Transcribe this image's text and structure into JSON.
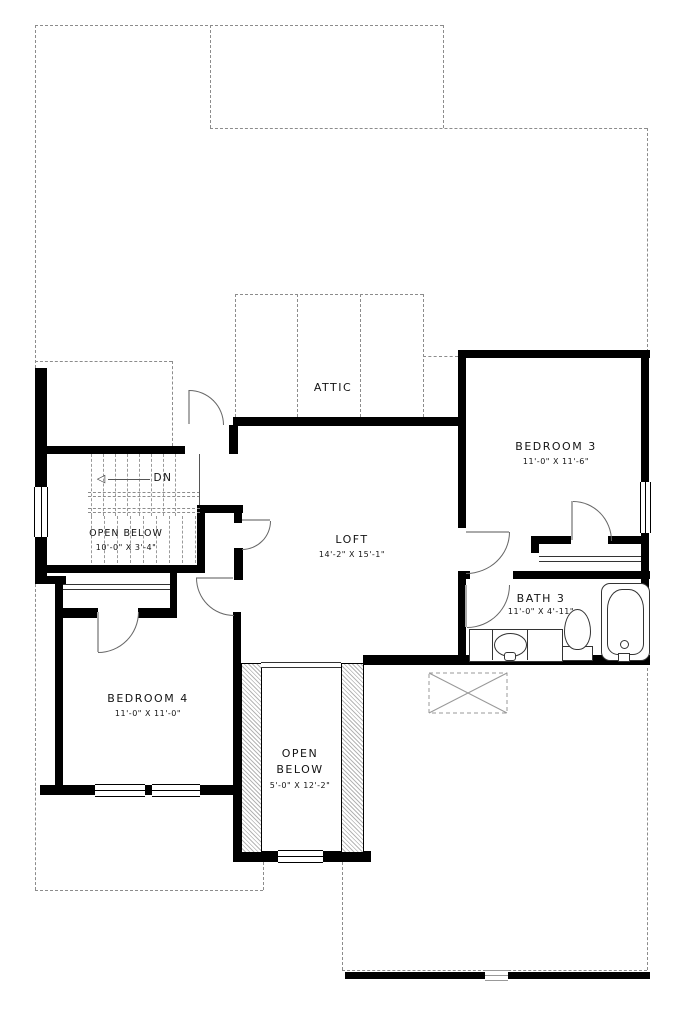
{
  "plan": {
    "title": "second-floor-plan",
    "labels": {
      "attic": "ATTIC",
      "dn": "DN",
      "down_arrow": "◁"
    },
    "rooms": {
      "loft": {
        "name": "LOFT",
        "dims": "14'-2\" X 15'-1\""
      },
      "bedroom3": {
        "name": "BEDROOM 3",
        "dims": "11'-0\" X 11'-6\""
      },
      "bedroom4": {
        "name": "BEDROOM 4",
        "dims": "11'-0\" X 11'-0\""
      },
      "bath3": {
        "name": "BATH 3",
        "dims": "11'-0\" X 4'-11\""
      },
      "open_below_stairs": {
        "name": "OPEN BELOW",
        "dims": "10'-0\" X 3'-4\""
      },
      "open_below_chase": {
        "line1": "OPEN",
        "line2": "BELOW",
        "dims": "5'-0\" X 12'-2\""
      }
    },
    "colors": {
      "wall": "#000000",
      "dashed_line": "#8c8c8c",
      "door_arc": "#666666",
      "text": "#141414",
      "background": "#ffffff"
    }
  }
}
